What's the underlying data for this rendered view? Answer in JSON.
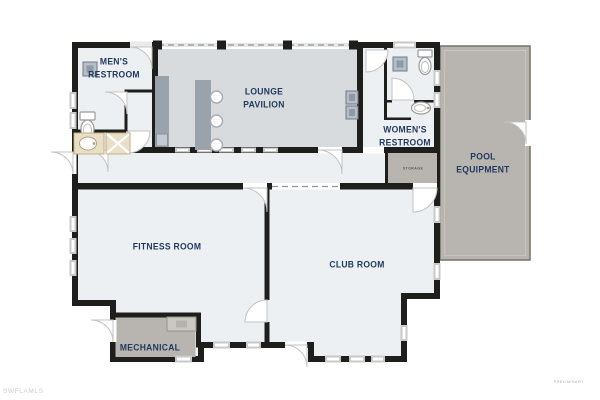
{
  "watermarks": {
    "brand": "SWFLAMLS",
    "status": "PRELIMINARY"
  },
  "floorplan": {
    "rooms": {
      "mens_restroom": {
        "label": "MEN'S\nRESTROOM"
      },
      "lounge_pavilion": {
        "label": "LOUNGE\nPAVILION"
      },
      "womens_restroom": {
        "label": "WOMEN'S\nRESTROOM"
      },
      "pool_equipment": {
        "label": "POOL\nEQUIPMENT"
      },
      "storage": {
        "label": "STORAGE"
      },
      "fitness_room": {
        "label": "FITNESS ROOM"
      },
      "club_room": {
        "label": "CLUB ROOM"
      },
      "mechanical": {
        "label": "MECHANICAL"
      }
    },
    "colors": {
      "wall": "#1e1e1c",
      "room_fill": "#edf0f3",
      "pavilion_fill": "#d7dbde",
      "service_fill": "#b8b5b0",
      "counter_fill": "#9aa2ac",
      "fixture_tan": "#e9dfc7",
      "label": "#21395c",
      "storage_label": "#5d5b55",
      "watermark": "#cccccc",
      "preliminary": "#b5b5b5"
    }
  }
}
